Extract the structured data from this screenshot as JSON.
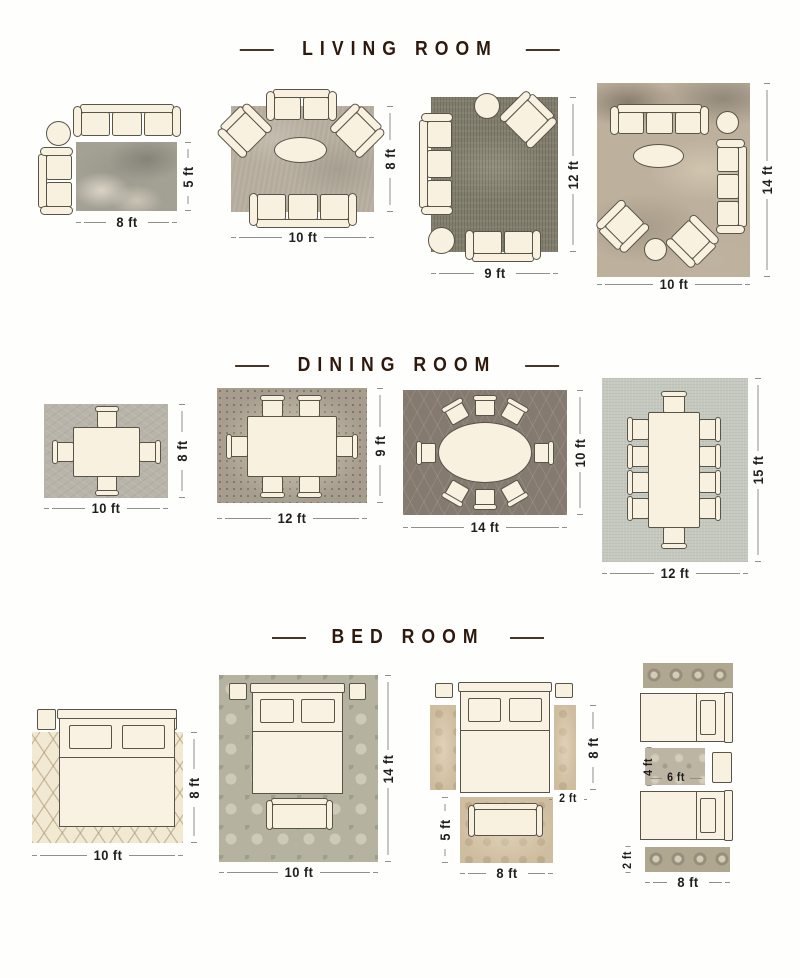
{
  "living_room": {
    "title": "LIVING ROOM",
    "layouts": [
      {
        "rug_width": "8 ft",
        "rug_height": "5 ft"
      },
      {
        "rug_width": "10 ft",
        "rug_height": "8 ft"
      },
      {
        "rug_width": "9 ft",
        "rug_height": "12 ft"
      },
      {
        "rug_width": "10 ft",
        "rug_height": "14 ft"
      }
    ]
  },
  "dining_room": {
    "title": "DINING ROOM",
    "layouts": [
      {
        "rug_width": "10 ft",
        "rug_height": "8 ft"
      },
      {
        "rug_width": "12 ft",
        "rug_height": "9 ft"
      },
      {
        "rug_width": "14 ft",
        "rug_height": "10 ft"
      },
      {
        "rug_width": "12 ft",
        "rug_height": "15 ft"
      }
    ]
  },
  "bed_room": {
    "title": "BED ROOM",
    "layouts": [
      {
        "rug_width": "10 ft",
        "rug_height": "8 ft"
      },
      {
        "rug_width": "10 ft",
        "rug_height": "14 ft"
      },
      {
        "runner_height": "8 ft",
        "runner_width": "2 ft",
        "accent_rug_height": "5 ft",
        "accent_rug_width": "8 ft"
      },
      {
        "accent_rug_height": "4 ft",
        "accent_rug_width": "6 ft",
        "runner_height": "2 ft",
        "runner_width": "8 ft"
      }
    ]
  },
  "colors": {
    "title_text": "#2e190c",
    "dimension_text": "#1e1e1c",
    "dimension_line": "#8f8f8b",
    "furniture_fill": "#f8f1e0",
    "furniture_outline": "#57544a"
  }
}
